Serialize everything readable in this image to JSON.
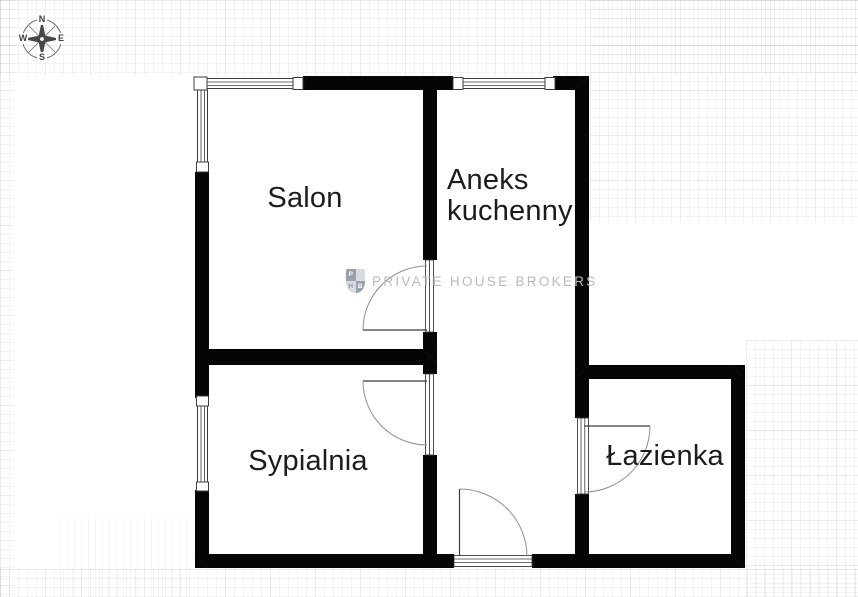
{
  "rooms": [
    {
      "label": "Salon"
    },
    {
      "label": "Aneks kuchenny"
    },
    {
      "label": "Sypialnia"
    },
    {
      "label": "Łazienka"
    }
  ],
  "watermark": {
    "text": "PRIVATE HOUSE BROKERS",
    "logo": {
      "tl": "P",
      "bl": "H",
      "br": "B"
    }
  },
  "compass": {
    "n": "N",
    "e": "E",
    "s": "S",
    "w": "W"
  },
  "colors": {
    "wall": "#050505",
    "label_text": "#1c1c1c",
    "watermark_text": "#b6bbc1",
    "door_arc": "#8f8f8f",
    "window_line": "#3c3c3c"
  }
}
